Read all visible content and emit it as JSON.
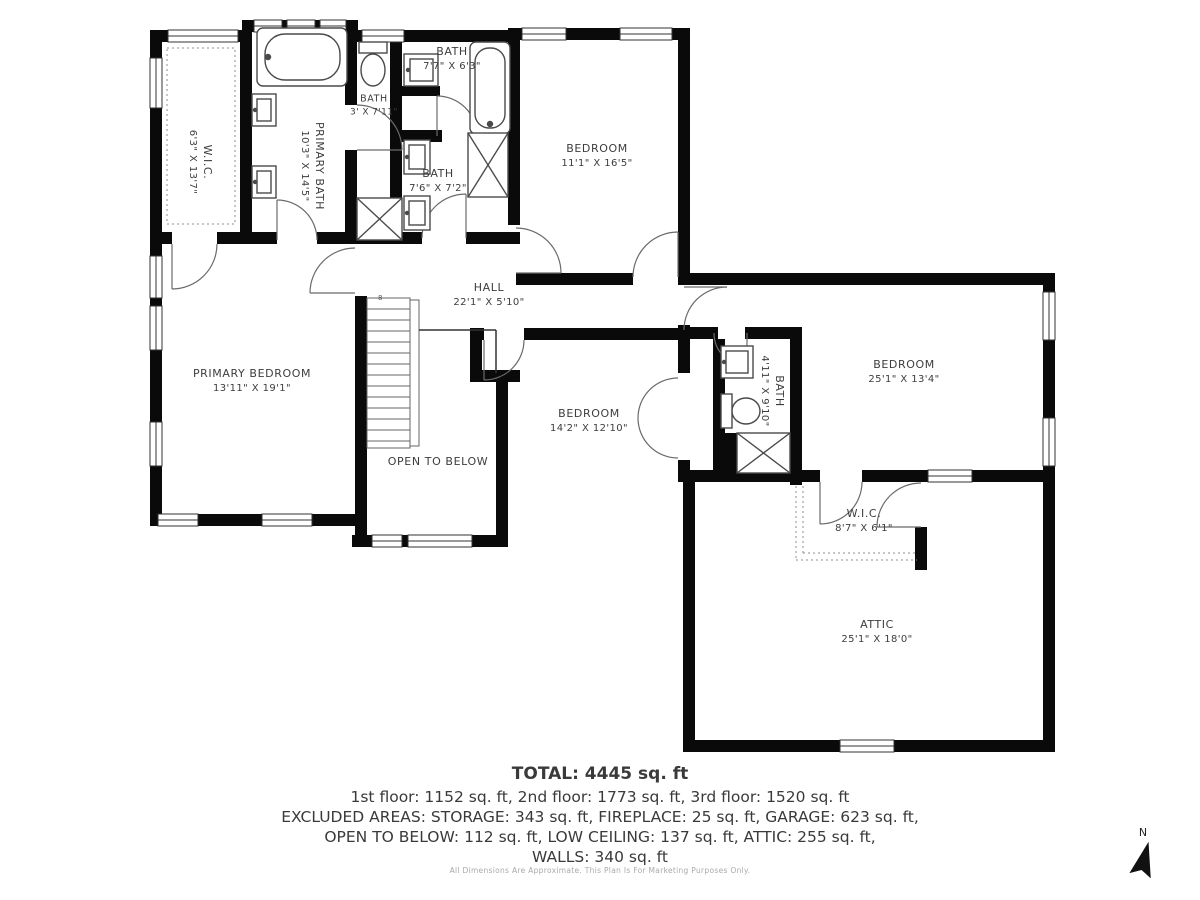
{
  "rooms": [
    {
      "name": "W.I.C.",
      "dims": "6'3\" X 13'7\""
    },
    {
      "name": "PRIMARY BATH",
      "dims": "10'3\" X 14'5\""
    },
    {
      "name": "BATH",
      "dims": "3' X 7'11\""
    },
    {
      "name": "BATH",
      "dims": "7'7\" X 6'3\""
    },
    {
      "name": "BATH",
      "dims": "7'6\" X 7'2\""
    },
    {
      "name": "BEDROOM",
      "dims": "11'1\" X 16'5\""
    },
    {
      "name": "HALL",
      "dims": "22'1\" X 5'10\""
    },
    {
      "name": "PRIMARY BEDROOM",
      "dims": "13'11\" X 19'1\""
    },
    {
      "name": "OPEN TO BELOW",
      "dims": ""
    },
    {
      "name": "BEDROOM",
      "dims": "14'2\" X 12'10\""
    },
    {
      "name": "BATH",
      "dims": "4'11\" X 9'10\""
    },
    {
      "name": "BEDROOM",
      "dims": "25'1\" X 13'4\""
    },
    {
      "name": "W.I.C.",
      "dims": "8'7\" X 6'1\""
    },
    {
      "name": "ATTIC",
      "dims": "25'1\" X 18'0\""
    }
  ],
  "summary": {
    "total": "TOTAL: 4445 sq. ft",
    "floors": "1st floor: 1152 sq. ft, 2nd floor: 1773 sq. ft, 3rd floor: 1520 sq. ft",
    "excluded1": "EXCLUDED AREAS: STORAGE: 343 sq. ft, FIREPLACE: 25 sq. ft, GARAGE: 623 sq. ft,",
    "excluded2": "OPEN TO BELOW: 112 sq. ft, LOW CEILING: 137 sq. ft, ATTIC: 255 sq. ft,",
    "walls": "WALLS: 340 sq. ft"
  },
  "disclaimer": "All Dimensions Are Approximate. This Plan Is For Marketing Purposes Only.",
  "compass": {
    "label": "N"
  },
  "stairs": {
    "count_label": "8"
  },
  "colors": {
    "wall": "#0a0a0a",
    "fixture_stroke": "#4a4a4a",
    "door_stroke": "#6a6a6a",
    "label": "#3d3d3d",
    "disclaimer": "#a9a9a9",
    "background": "#ffffff"
  }
}
